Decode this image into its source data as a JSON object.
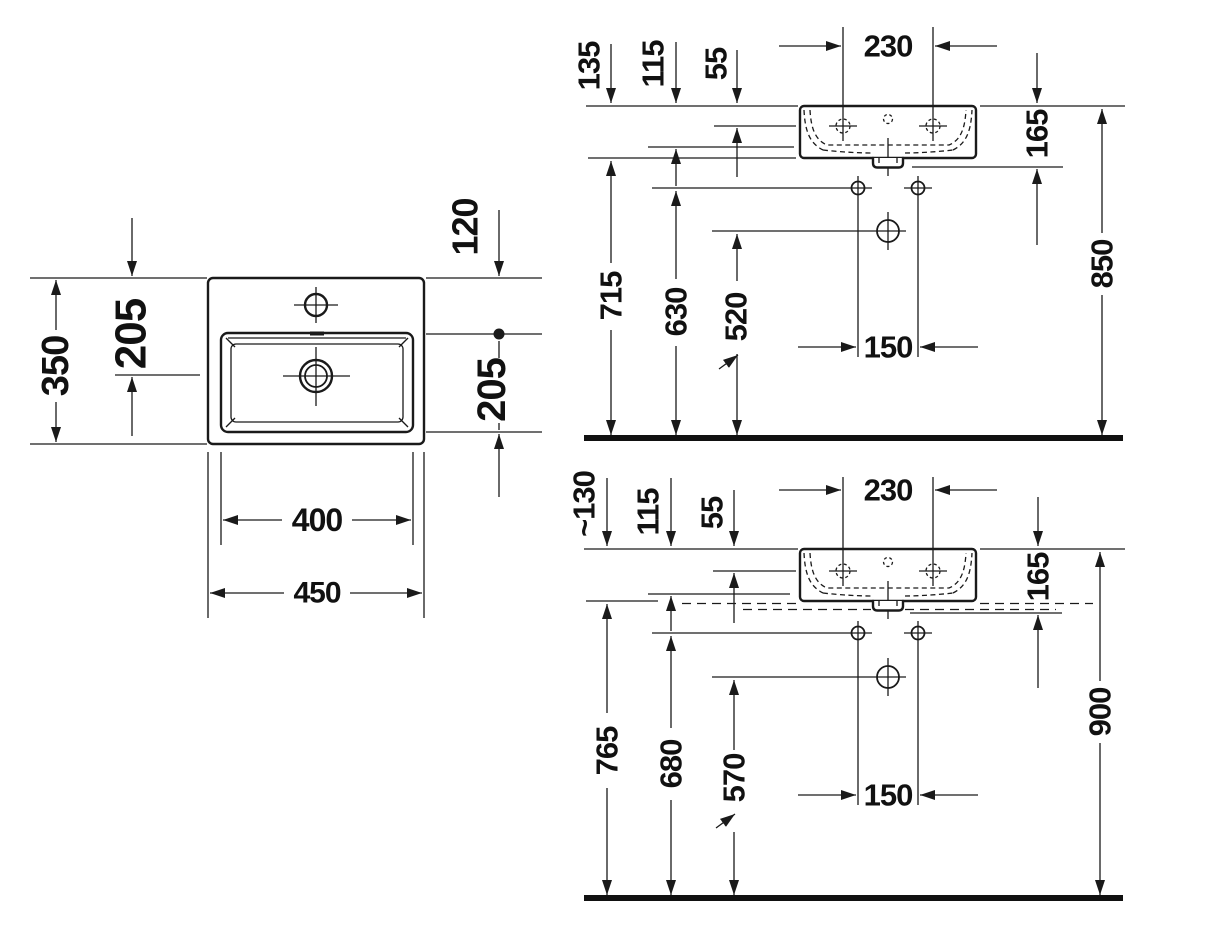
{
  "colors": {
    "ink": "#1a1a1a",
    "background": "#ffffff"
  },
  "drawing": {
    "plan": {
      "overall_width": "450",
      "bowl_width": "400",
      "overall_depth": "350",
      "back_to_drain": "205",
      "bowl_front_depth": "205",
      "back_to_bowl_edge": "120"
    },
    "wall": {
      "tap_hole_spacing": "230",
      "rim_to_tap_holes": "55",
      "rim_to_bowl_bottom": "115",
      "rim_to_underside": "135",
      "rim_to_outlet": "165",
      "floor_to_underside": "715",
      "floor_to_fixing_holes": "630",
      "floor_to_waste": "520",
      "fixing_hole_spacing": "150",
      "floor_to_rim": "850"
    },
    "counter": {
      "tap_hole_spacing": "230",
      "rim_to_tap_holes": "55",
      "rim_to_bowl_bottom": "115",
      "rim_to_counter": "~130",
      "rim_to_outlet": "165",
      "floor_to_underside": "765",
      "floor_to_fixing_holes": "680",
      "floor_to_waste": "570",
      "fixing_hole_spacing": "150",
      "floor_to_rim": "900"
    }
  }
}
